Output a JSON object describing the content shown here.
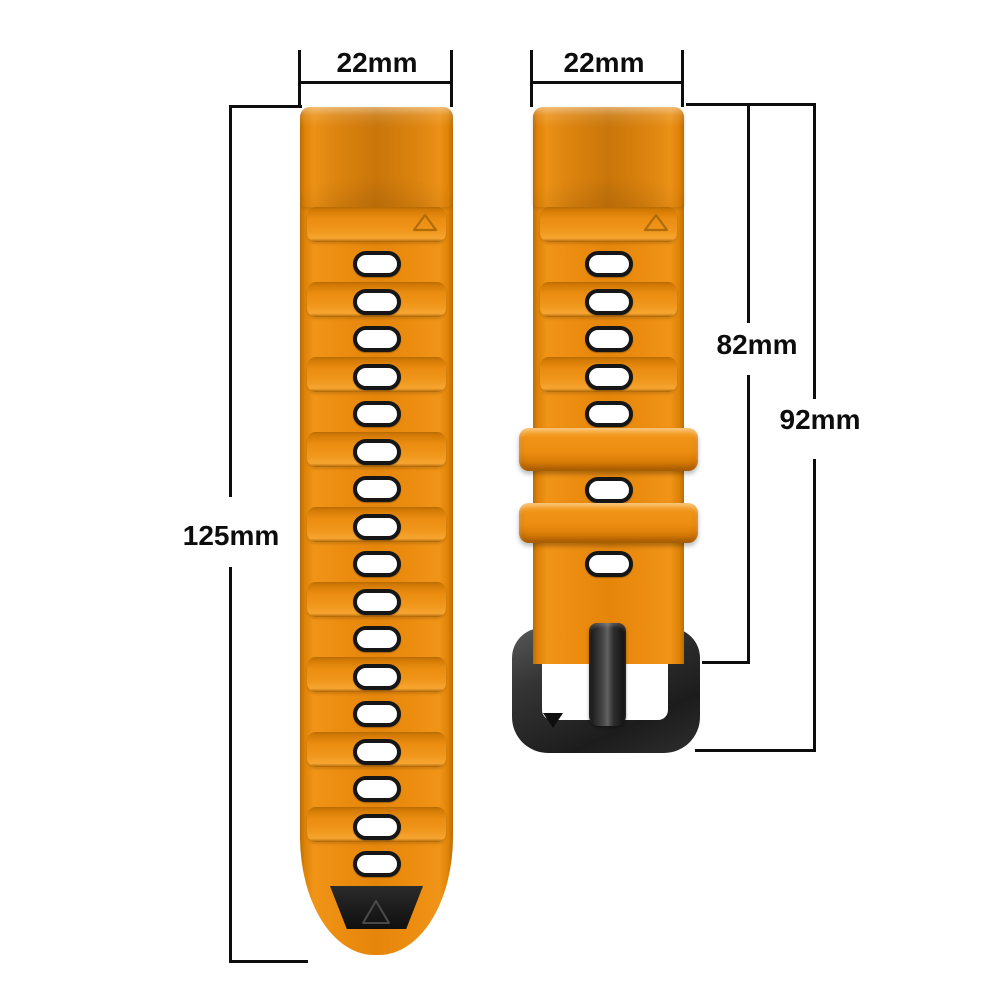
{
  "background": "#ffffff",
  "annotation": {
    "line_color": "#0d0d0d",
    "labels": {
      "long_width": "22mm",
      "short_width": "22mm",
      "long_length": "125mm",
      "short_length_to_buckle": "82mm",
      "short_length_total": "92mm"
    }
  },
  "product": {
    "strap_color": "#ec8d10",
    "strap_color_dark": "#b96d05",
    "strap_color_light": "#f6a531",
    "accent_black": "#1b1b1b",
    "buckle_color": "#2e2e2e",
    "hole_fill": "#ffffff",
    "hole_border": "#161616",
    "long_strap": {
      "hole_count": 17,
      "band_count": 9,
      "has_black_tip": true
    },
    "short_strap": {
      "hole_count": 7,
      "band_count": 3,
      "keeper_count": 2,
      "has_buckle": true
    }
  }
}
